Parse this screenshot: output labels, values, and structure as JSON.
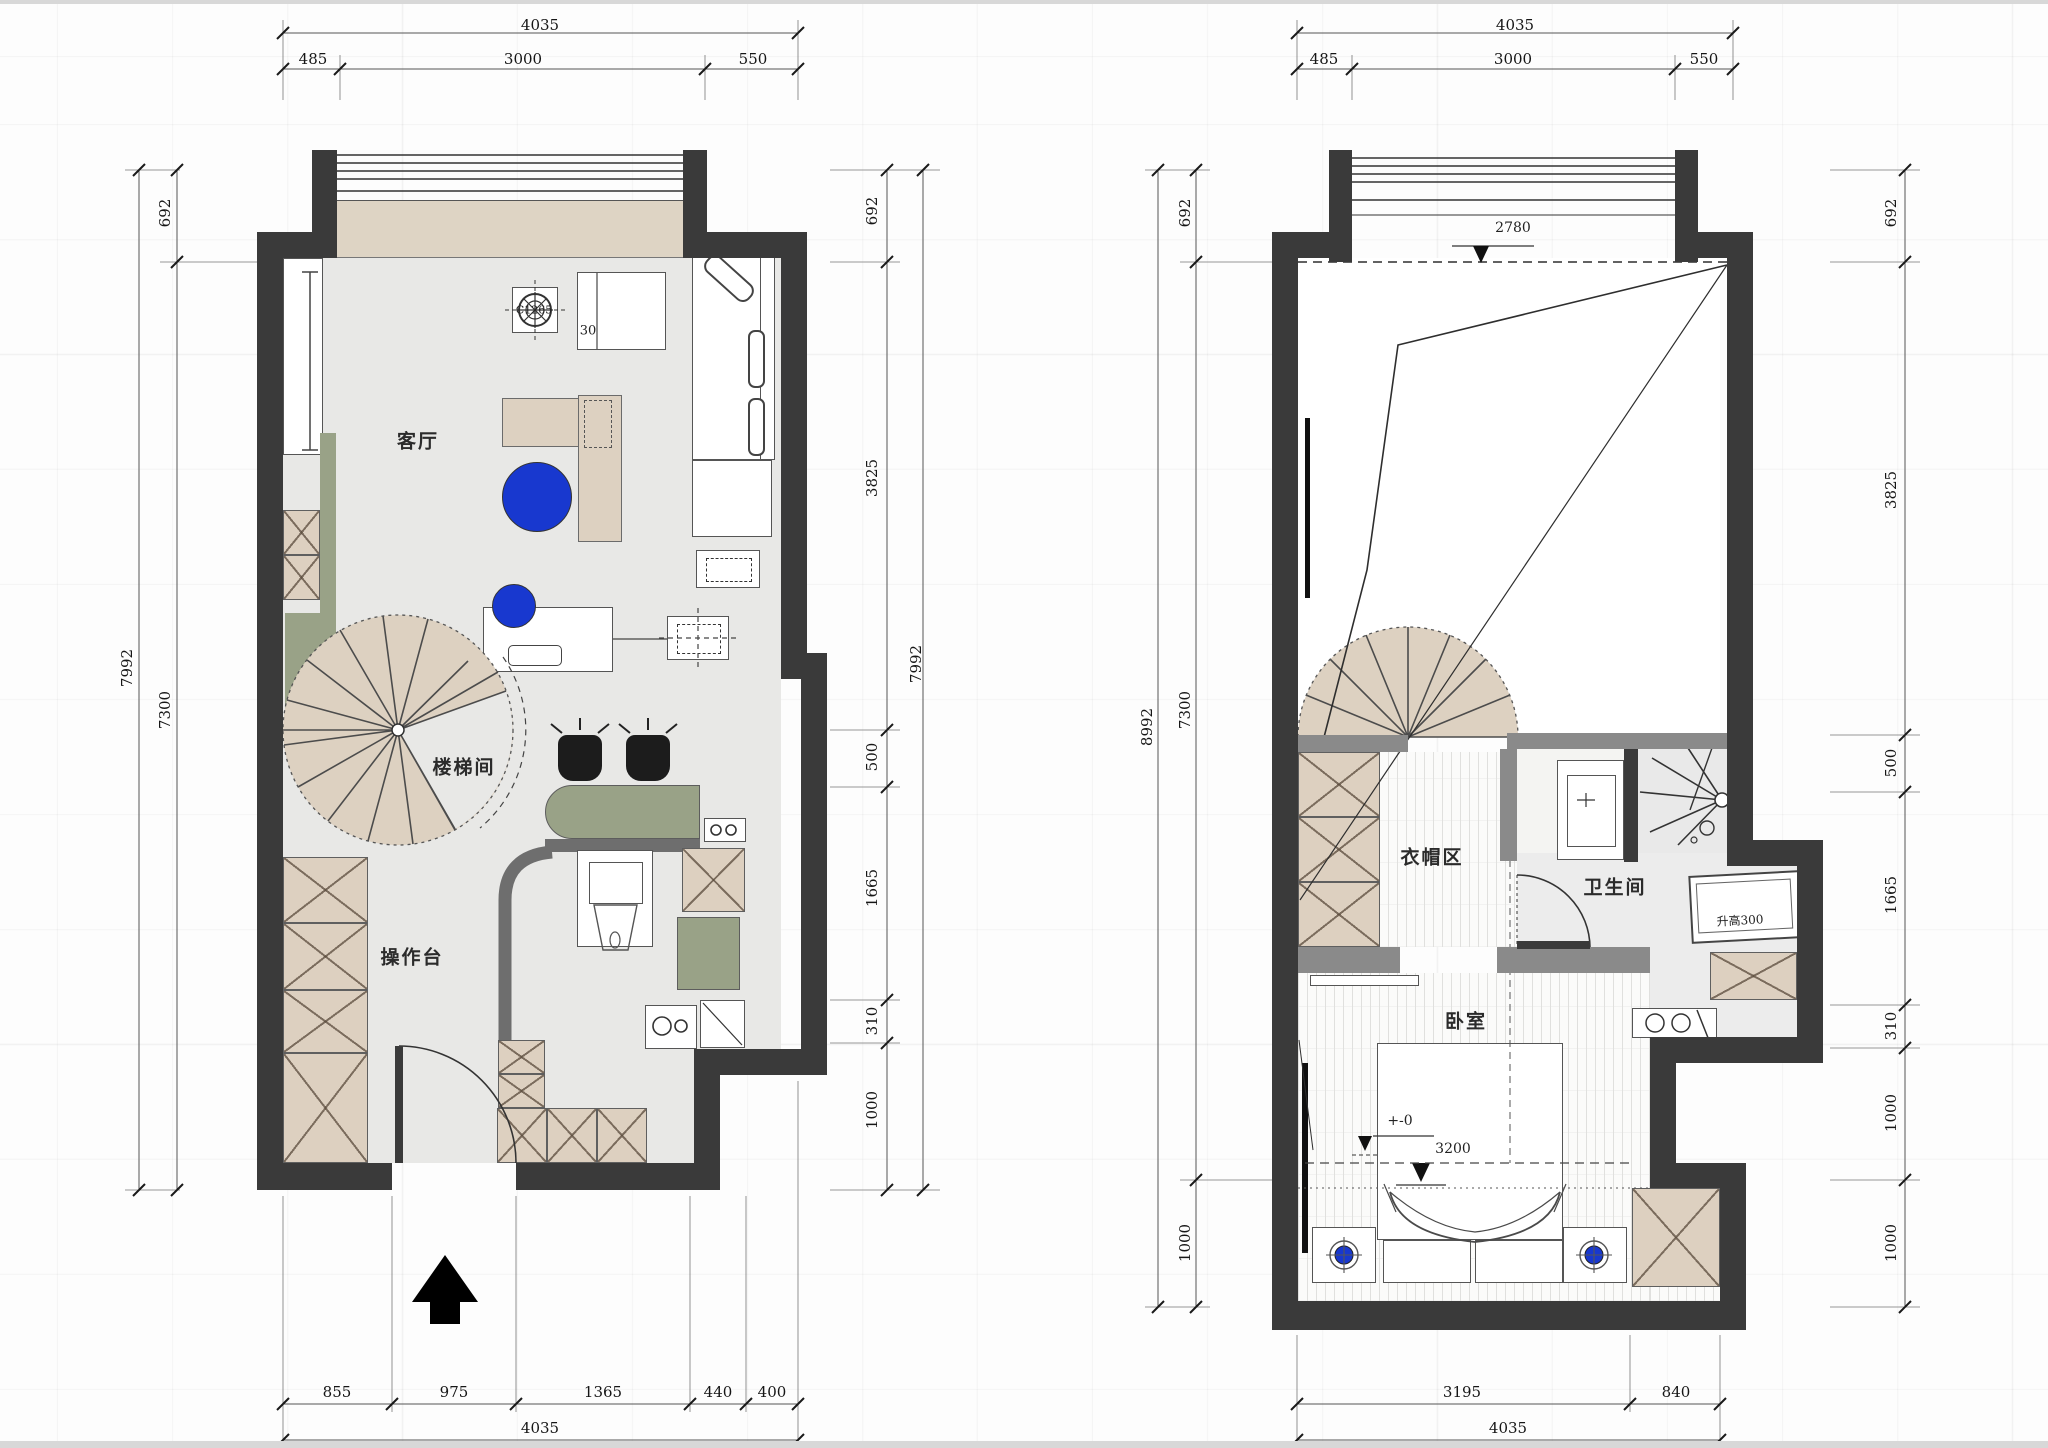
{
  "left_plan": {
    "rooms": {
      "living": "客厅",
      "stairwell": "楼梯间",
      "worktop": "操作台"
    },
    "annotations": {
      "fan_label": "C1265",
      "cabinet_label": "30"
    },
    "dims": {
      "top_total": "4035",
      "top_segments": [
        "485",
        "3000",
        "550"
      ],
      "left_outer": "7992",
      "left_inner": [
        "692",
        "7300"
      ],
      "right_outer": "7992",
      "right_inner": [
        "692",
        "3825",
        "500",
        "1665",
        "310",
        "1000"
      ],
      "bottom_segments": [
        "855",
        "975",
        "1365",
        "440",
        "400"
      ],
      "bottom_total": "4035"
    }
  },
  "right_plan": {
    "rooms": {
      "cloak": "衣帽区",
      "bath": "卫生间",
      "bedroom": "卧室"
    },
    "annotations": {
      "ceiling_height": "2780",
      "zero_level": "+-0",
      "bed_dim": "3200",
      "platform": "升高300"
    },
    "dims": {
      "top_total": "4035",
      "top_segments": [
        "485",
        "3000",
        "550"
      ],
      "left_outer": "8992",
      "left_inner": [
        "692",
        "7300",
        "1000"
      ],
      "right_inner": [
        "692",
        "3825",
        "500",
        "1665",
        "310",
        "1000",
        "1000"
      ],
      "bottom_segments": [
        "3195",
        "840"
      ],
      "bottom_total": "4035"
    }
  }
}
